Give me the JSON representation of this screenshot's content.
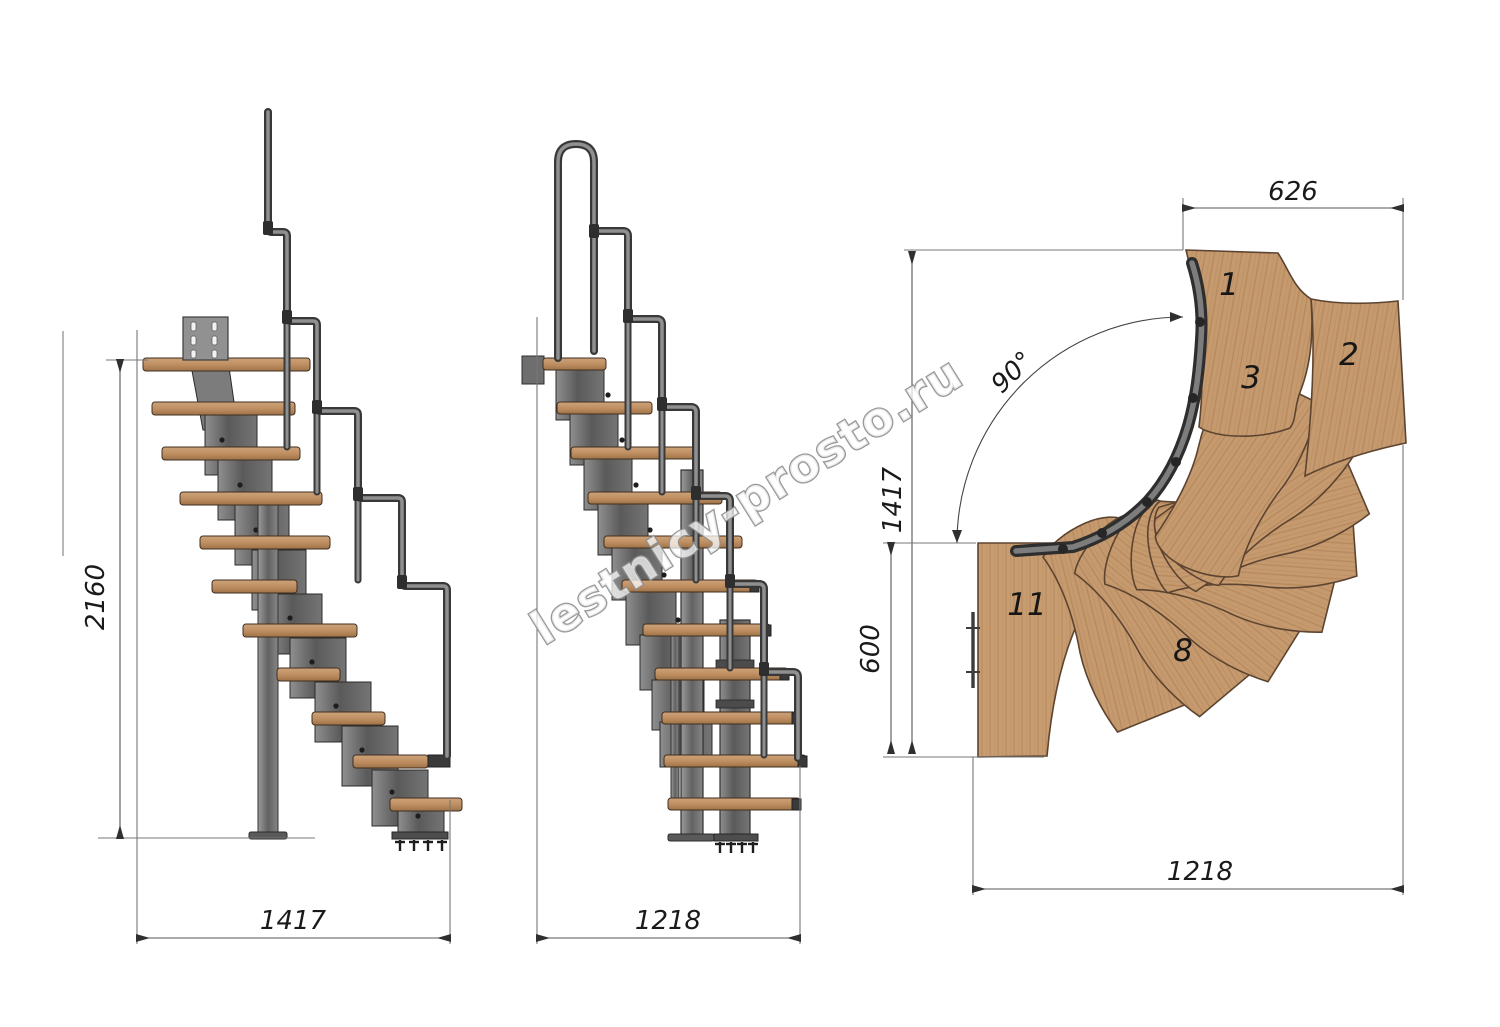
{
  "watermark": "lestnicy-prosto.ru",
  "side_view": {
    "height_dim": "2160",
    "width_dim": "1417"
  },
  "front_view": {
    "width_dim": "1218"
  },
  "plan_view": {
    "top_width_dim": "626",
    "angle_dim": "90°",
    "depth_total_dim": "1417",
    "landing_depth_dim": "600",
    "bottom_width_dim": "1218",
    "tread_numbers": [
      "1",
      "2",
      "3",
      "8",
      "11"
    ]
  }
}
